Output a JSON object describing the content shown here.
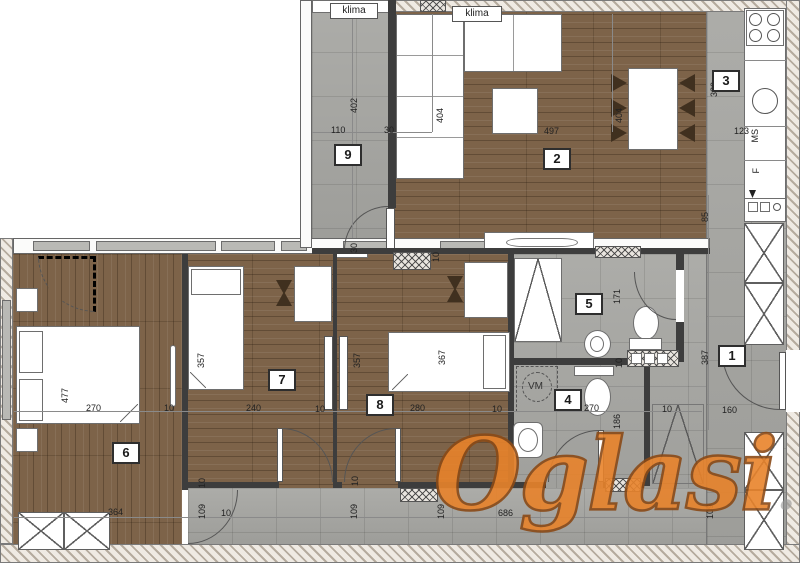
{
  "watermark": {
    "main": "Oglasi",
    "suffix": ".rs"
  },
  "room_labels": {
    "r1": "1",
    "r2": "2",
    "r3": "3",
    "r4": "4",
    "r5": "5",
    "r6": "6",
    "r7": "7",
    "r8": "8",
    "r9": "9"
  },
  "ac_units": {
    "left": "klima",
    "right": "klima"
  },
  "kitchen": {
    "ms": "MS",
    "f": "F"
  },
  "appliances": {
    "washing_machine": "VM"
  },
  "dimensions": {
    "terrace_width": "110",
    "terrace_height": "402",
    "terrace_wall": "30",
    "terrace_b30": "30",
    "living_left_depth": "404",
    "living_width": "497",
    "dining_depth": "404",
    "kitchen_height": "320",
    "kitchen_width": "123",
    "hall_top": "85",
    "hall_height": "387",
    "hall_bottom": "160",
    "bath5_height": "171",
    "bath_wall": "10",
    "bath4_width": "270",
    "bath4_height": "186",
    "bath4_right": "10",
    "bed6_height": "477",
    "bed6_width": "270",
    "bed6_right": "10",
    "bed7_height": "357",
    "bed7_width": "240",
    "bed7_right": "10",
    "bed8_height": "357",
    "bed8_bed": "367",
    "bed8_width": "280",
    "bed8_right": "10",
    "room8_t10": "10",
    "wardrobe6": "364",
    "corr_l10": "10",
    "corr_l109": "109",
    "corr_l10b": "10",
    "corr_m109": "109",
    "corr_m10": "10",
    "corr_r109": "109",
    "corr_width": "686",
    "corr_rr109": "109"
  },
  "colors": {
    "floor_wood": "#7d6349",
    "floor_tile": "#a7a7a3",
    "wall_dark": "#3d3d3d",
    "watermark_orange": "#e8832b"
  }
}
